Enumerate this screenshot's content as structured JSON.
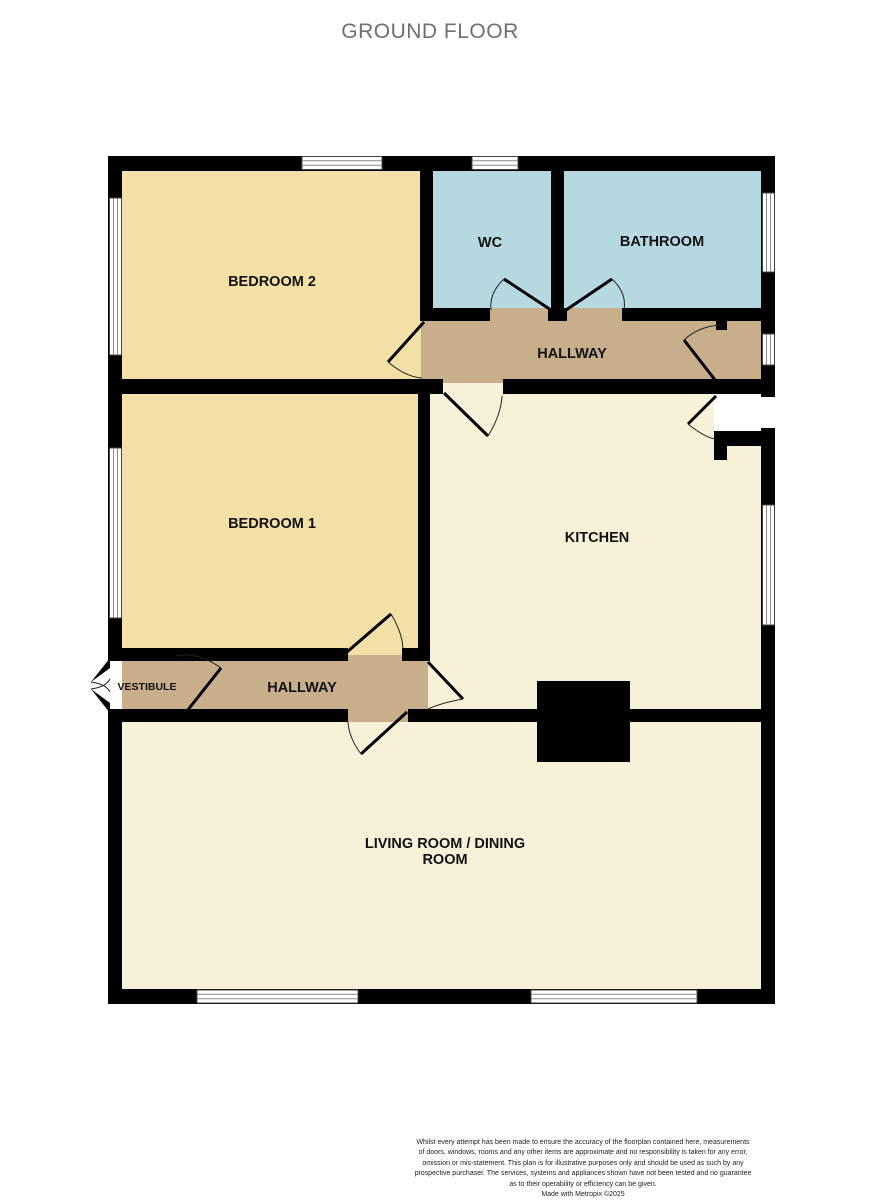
{
  "title": "GROUND FLOOR",
  "colors": {
    "bedroom": "#F2E0A6",
    "wet": "#B5D8E1",
    "hallway": "#C9AE8C",
    "living": "#F8F1D9",
    "wall": "#000000"
  },
  "rooms": {
    "bedroom2": {
      "label": "BEDROOM 2"
    },
    "wc": {
      "label": "WC"
    },
    "bathroom": {
      "label": "BATHROOM"
    },
    "hallway_top": {
      "label": "HALLWAY"
    },
    "bedroom1": {
      "label": "BEDROOM 1"
    },
    "kitchen": {
      "label": "KITCHEN"
    },
    "vestibule": {
      "label": "VESTIBULE"
    },
    "hallway_lower": {
      "label": "HALLWAY"
    },
    "living": {
      "label_line1": "LIVING ROOM / DINING",
      "label_line2": "ROOM"
    }
  },
  "footer": {
    "lines": [
      "Whilst every attempt has been made to ensure the accuracy of the floorplan contained here, measurements",
      "of doors, windows, rooms and any other items are approximate and no responsibility is taken for any error,",
      "omission or mis-statement. This plan is for illustrative purposes only and should be used as such by any",
      "prospective purchaser. The services, systems and appliances shown have not been tested and no guarantee",
      "as to their operability or efficiency can be given."
    ],
    "credit": "Made with Metropix ©2025"
  }
}
